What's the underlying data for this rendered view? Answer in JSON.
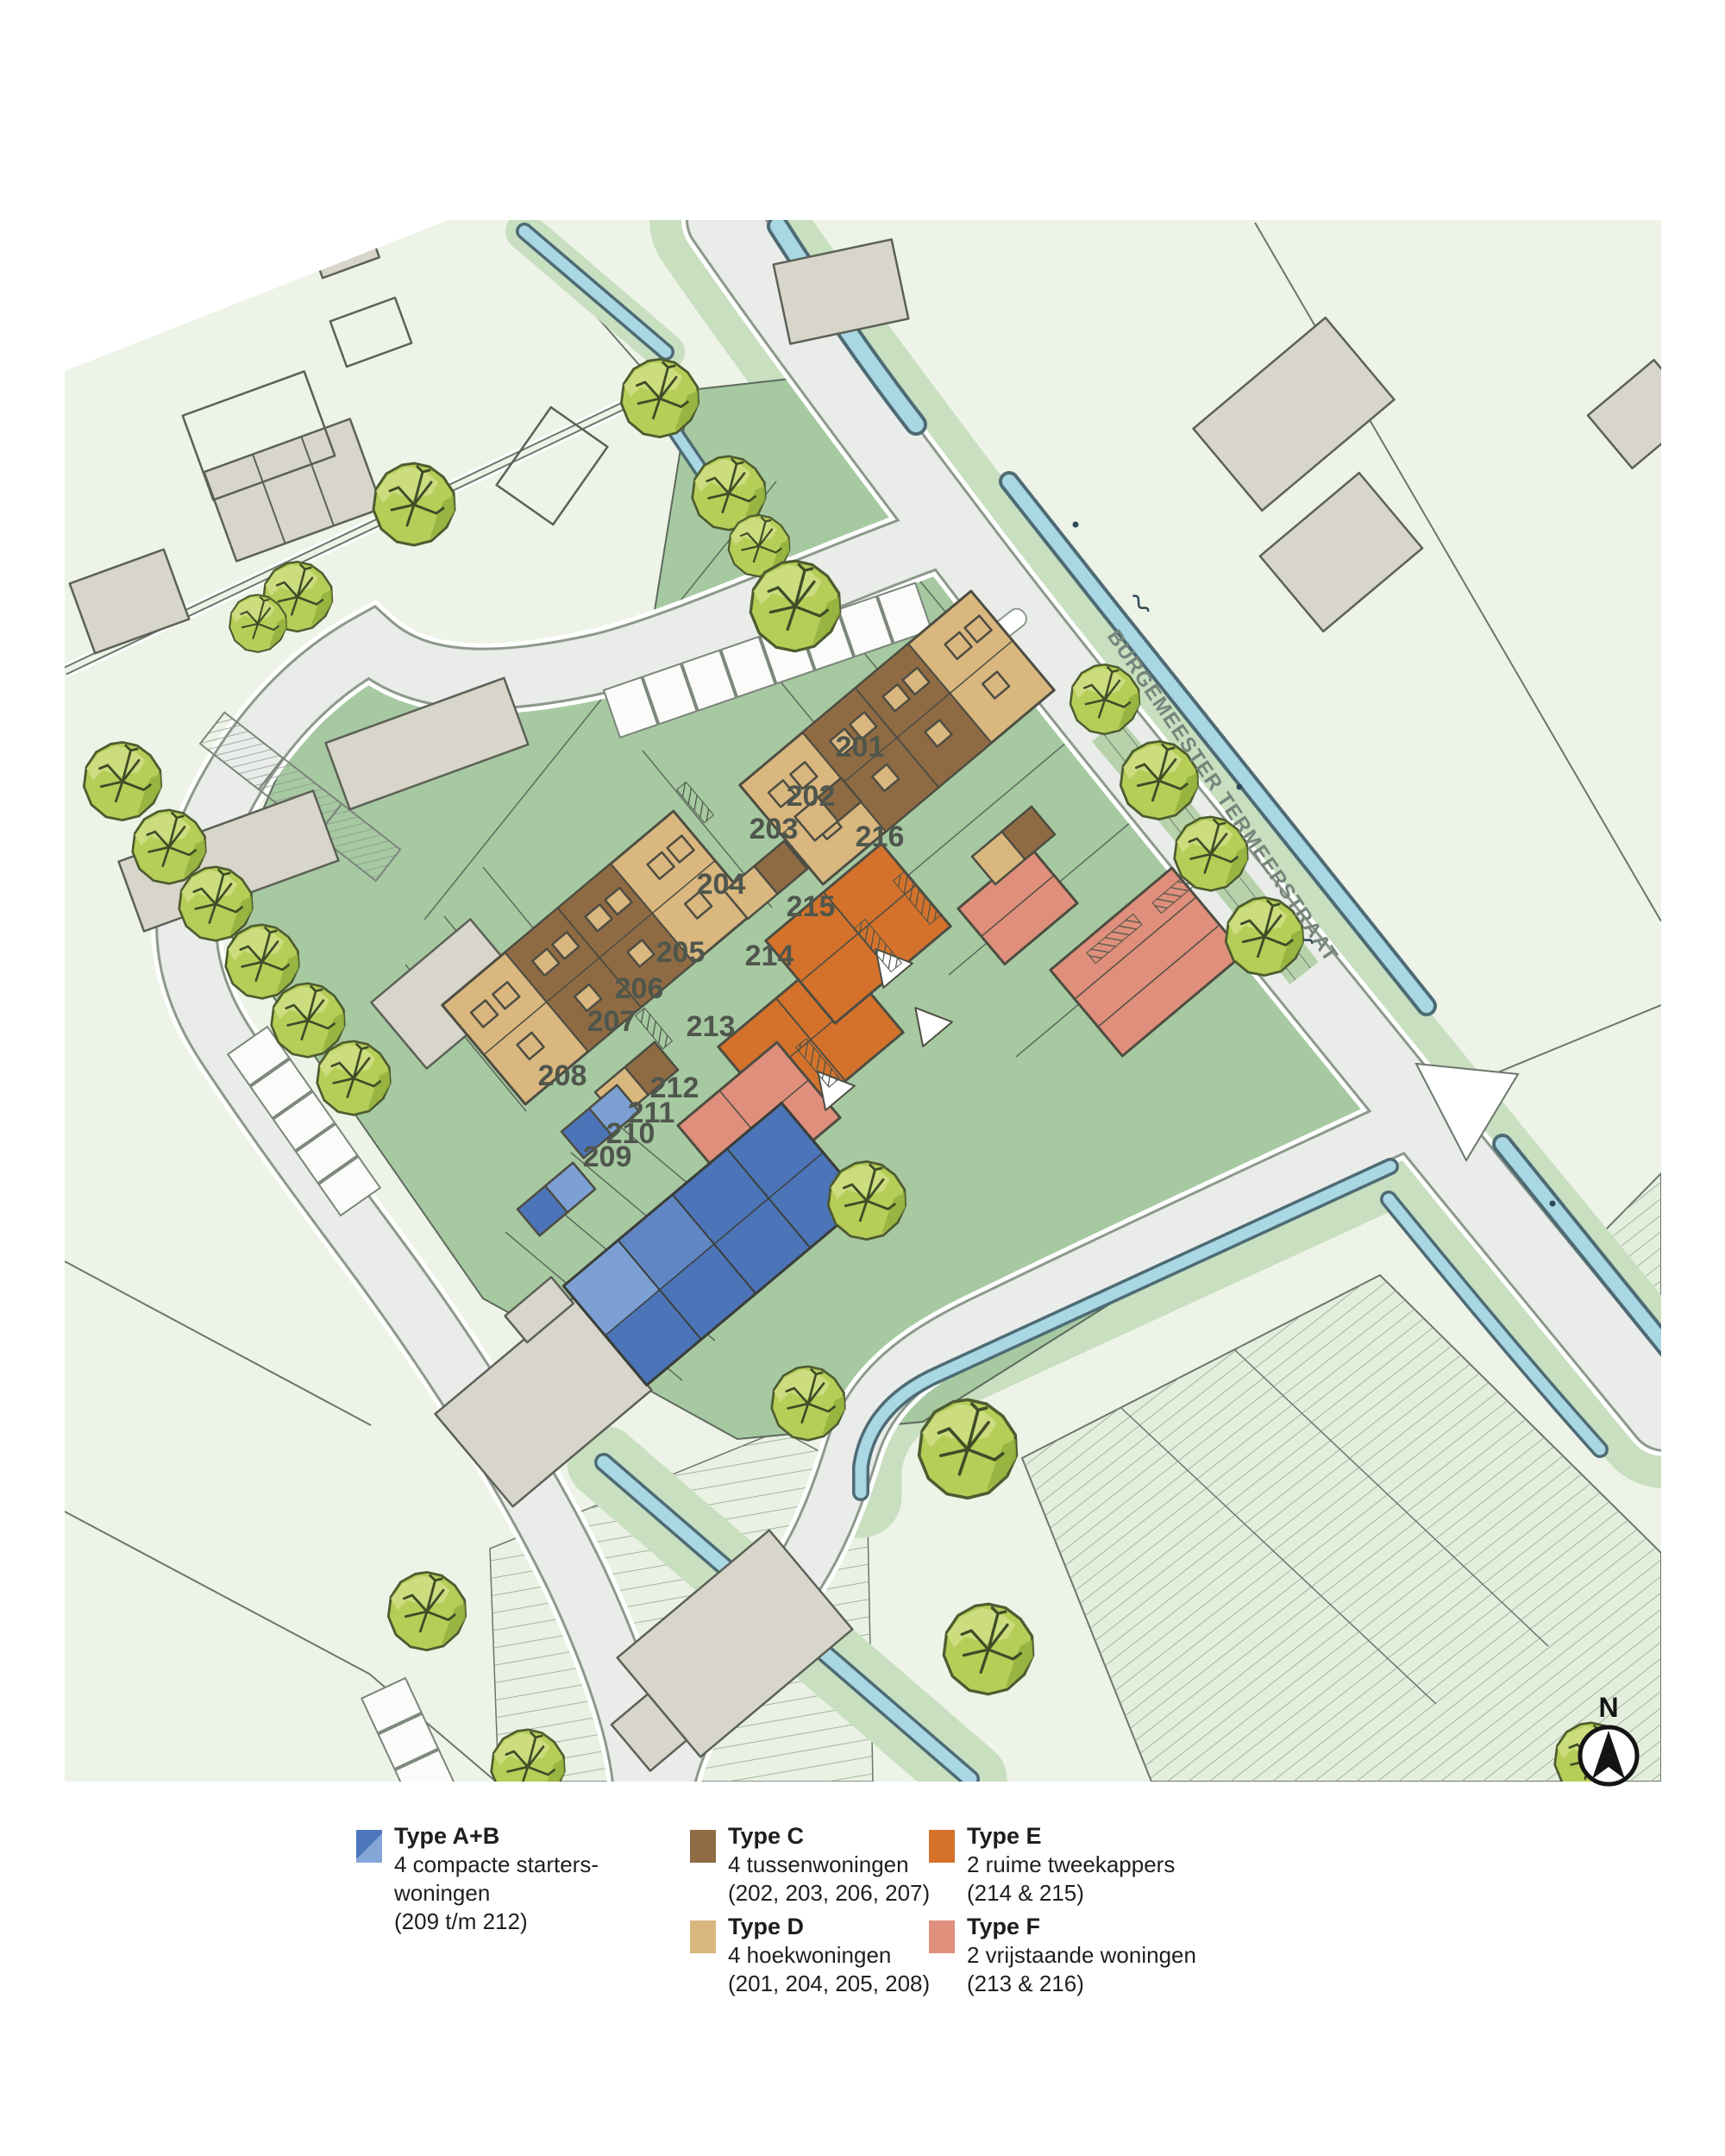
{
  "map": {
    "street_label": "BURGEMEESTER TERMEERSTRAAT",
    "compass_label": "N",
    "plot_labels": [
      "201",
      "202",
      "203",
      "204",
      "205",
      "206",
      "207",
      "208",
      "209",
      "210",
      "211",
      "212",
      "213",
      "214",
      "215",
      "216"
    ],
    "icons": {
      "north_arrow": "north-arrow-icon",
      "tree": "tree-icon",
      "water": "canal-strip"
    }
  },
  "legend": {
    "items": [
      {
        "type": "A+B",
        "title": "Type A+B",
        "lines": [
          "4 compacte starters-",
          "woningen",
          "(209 t/m 212)"
        ],
        "color_dark": "#4e77bb",
        "color_light": "#84a7d8"
      },
      {
        "type": "C",
        "title": "Type C",
        "lines": [
          "4 tussenwoningen",
          "(202, 203, 206, 207)"
        ],
        "color": "#8f6b44"
      },
      {
        "type": "D",
        "title": "Type D",
        "lines": [
          "4 hoekwoningen",
          "(201, 204, 205, 208)"
        ],
        "color": "#d9b77f"
      },
      {
        "type": "E",
        "title": "Type E",
        "lines": [
          "2 ruime tweekappers",
          "(214 & 215)"
        ],
        "color": "#d4722c"
      },
      {
        "type": "F",
        "title": "Type F",
        "lines": [
          "2 vrijstaande woningen",
          "(213 & 216)"
        ],
        "color": "#df8f7b"
      }
    ]
  },
  "colors": {
    "field_green": "#eef3e7",
    "site_green": "#a7c9a2",
    "bank_green": "#c8dfc0",
    "road_gray": "#e9ece9",
    "water_blue": "#a9d7e4",
    "tree_green": "#b6ce58",
    "building_gray": "#d8d5ca",
    "type_c_brown": "#8f6b44",
    "type_d_tan": "#d9b77f",
    "type_e_orange": "#d4722c",
    "type_f_salmon": "#df8f7b",
    "type_ab_blue": "#4c74b8"
  }
}
